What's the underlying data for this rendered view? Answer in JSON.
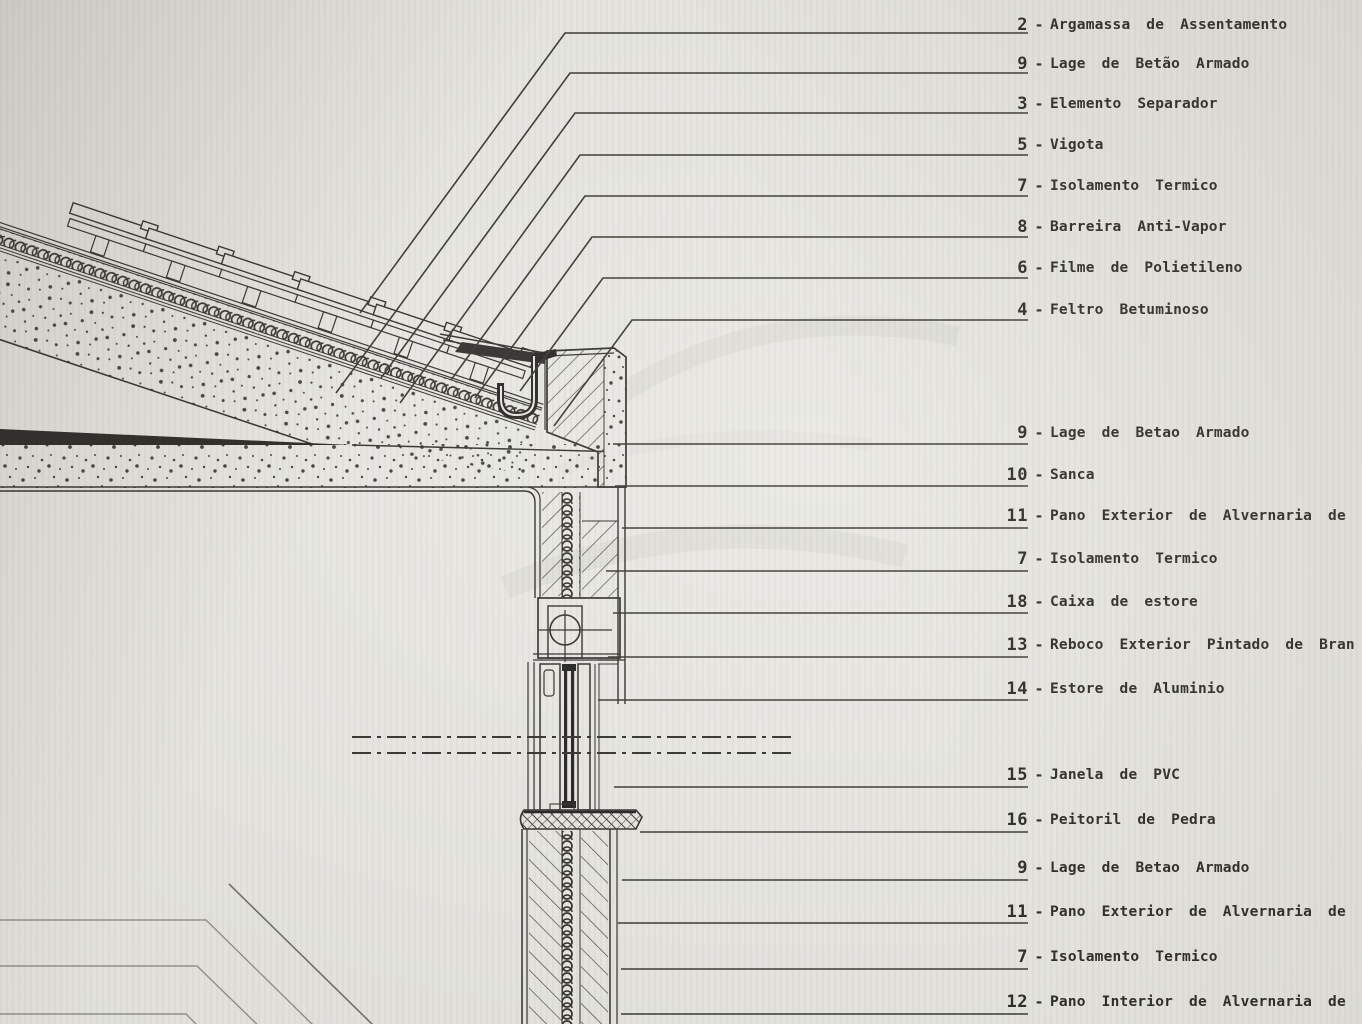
{
  "document": {
    "kind": "architectural construction detail section (scanned technical drawing)",
    "language": "Portuguese"
  },
  "colors": {
    "paper": "#e9e8e3",
    "ink": "#2c2a26",
    "ink_heavy": "#1d1c1a",
    "faint_line": "#93918a",
    "watermark": "#dbdad4"
  },
  "labels": {
    "separator": "-",
    "items": [
      {
        "num": "2",
        "text": "Argamassa de Assentamento"
      },
      {
        "num": "9",
        "text": "Lage de Betão Armado"
      },
      {
        "num": "3",
        "text": "Elemento Separador"
      },
      {
        "num": "5",
        "text": "Vigota"
      },
      {
        "num": "7",
        "text": "Isolamento Termico"
      },
      {
        "num": "8",
        "text": "Barreira Anti-Vapor"
      },
      {
        "num": "6",
        "text": "Filme de Polietileno"
      },
      {
        "num": "4",
        "text": "Feltro Betuminoso"
      },
      {
        "num": "9",
        "text": "Lage de Betao Armado"
      },
      {
        "num": "10",
        "text": "Sanca"
      },
      {
        "num": "11",
        "text": "Pano Exterior de Alvernaria de \"Tijolo de 1"
      },
      {
        "num": "7",
        "text": "Isolamento Termico"
      },
      {
        "num": "18",
        "text": "Caixa de estore"
      },
      {
        "num": "13",
        "text": "Reboco Exterior Pintado de Bran"
      },
      {
        "num": "14",
        "text": "Estore de Aluminio"
      },
      {
        "num": "15",
        "text": "Janela de PVC"
      },
      {
        "num": "16",
        "text": "Peitoril de Pedra"
      },
      {
        "num": "9",
        "text": "Lage de Betao Armado"
      },
      {
        "num": "11",
        "text": "Pano Exterior de Alvernaria de \"Tijolo de"
      },
      {
        "num": "7",
        "text": "Isolamento Termico"
      },
      {
        "num": "12",
        "text": "Pano Interior de Alvernaria de \"Tijolo de"
      }
    ]
  }
}
